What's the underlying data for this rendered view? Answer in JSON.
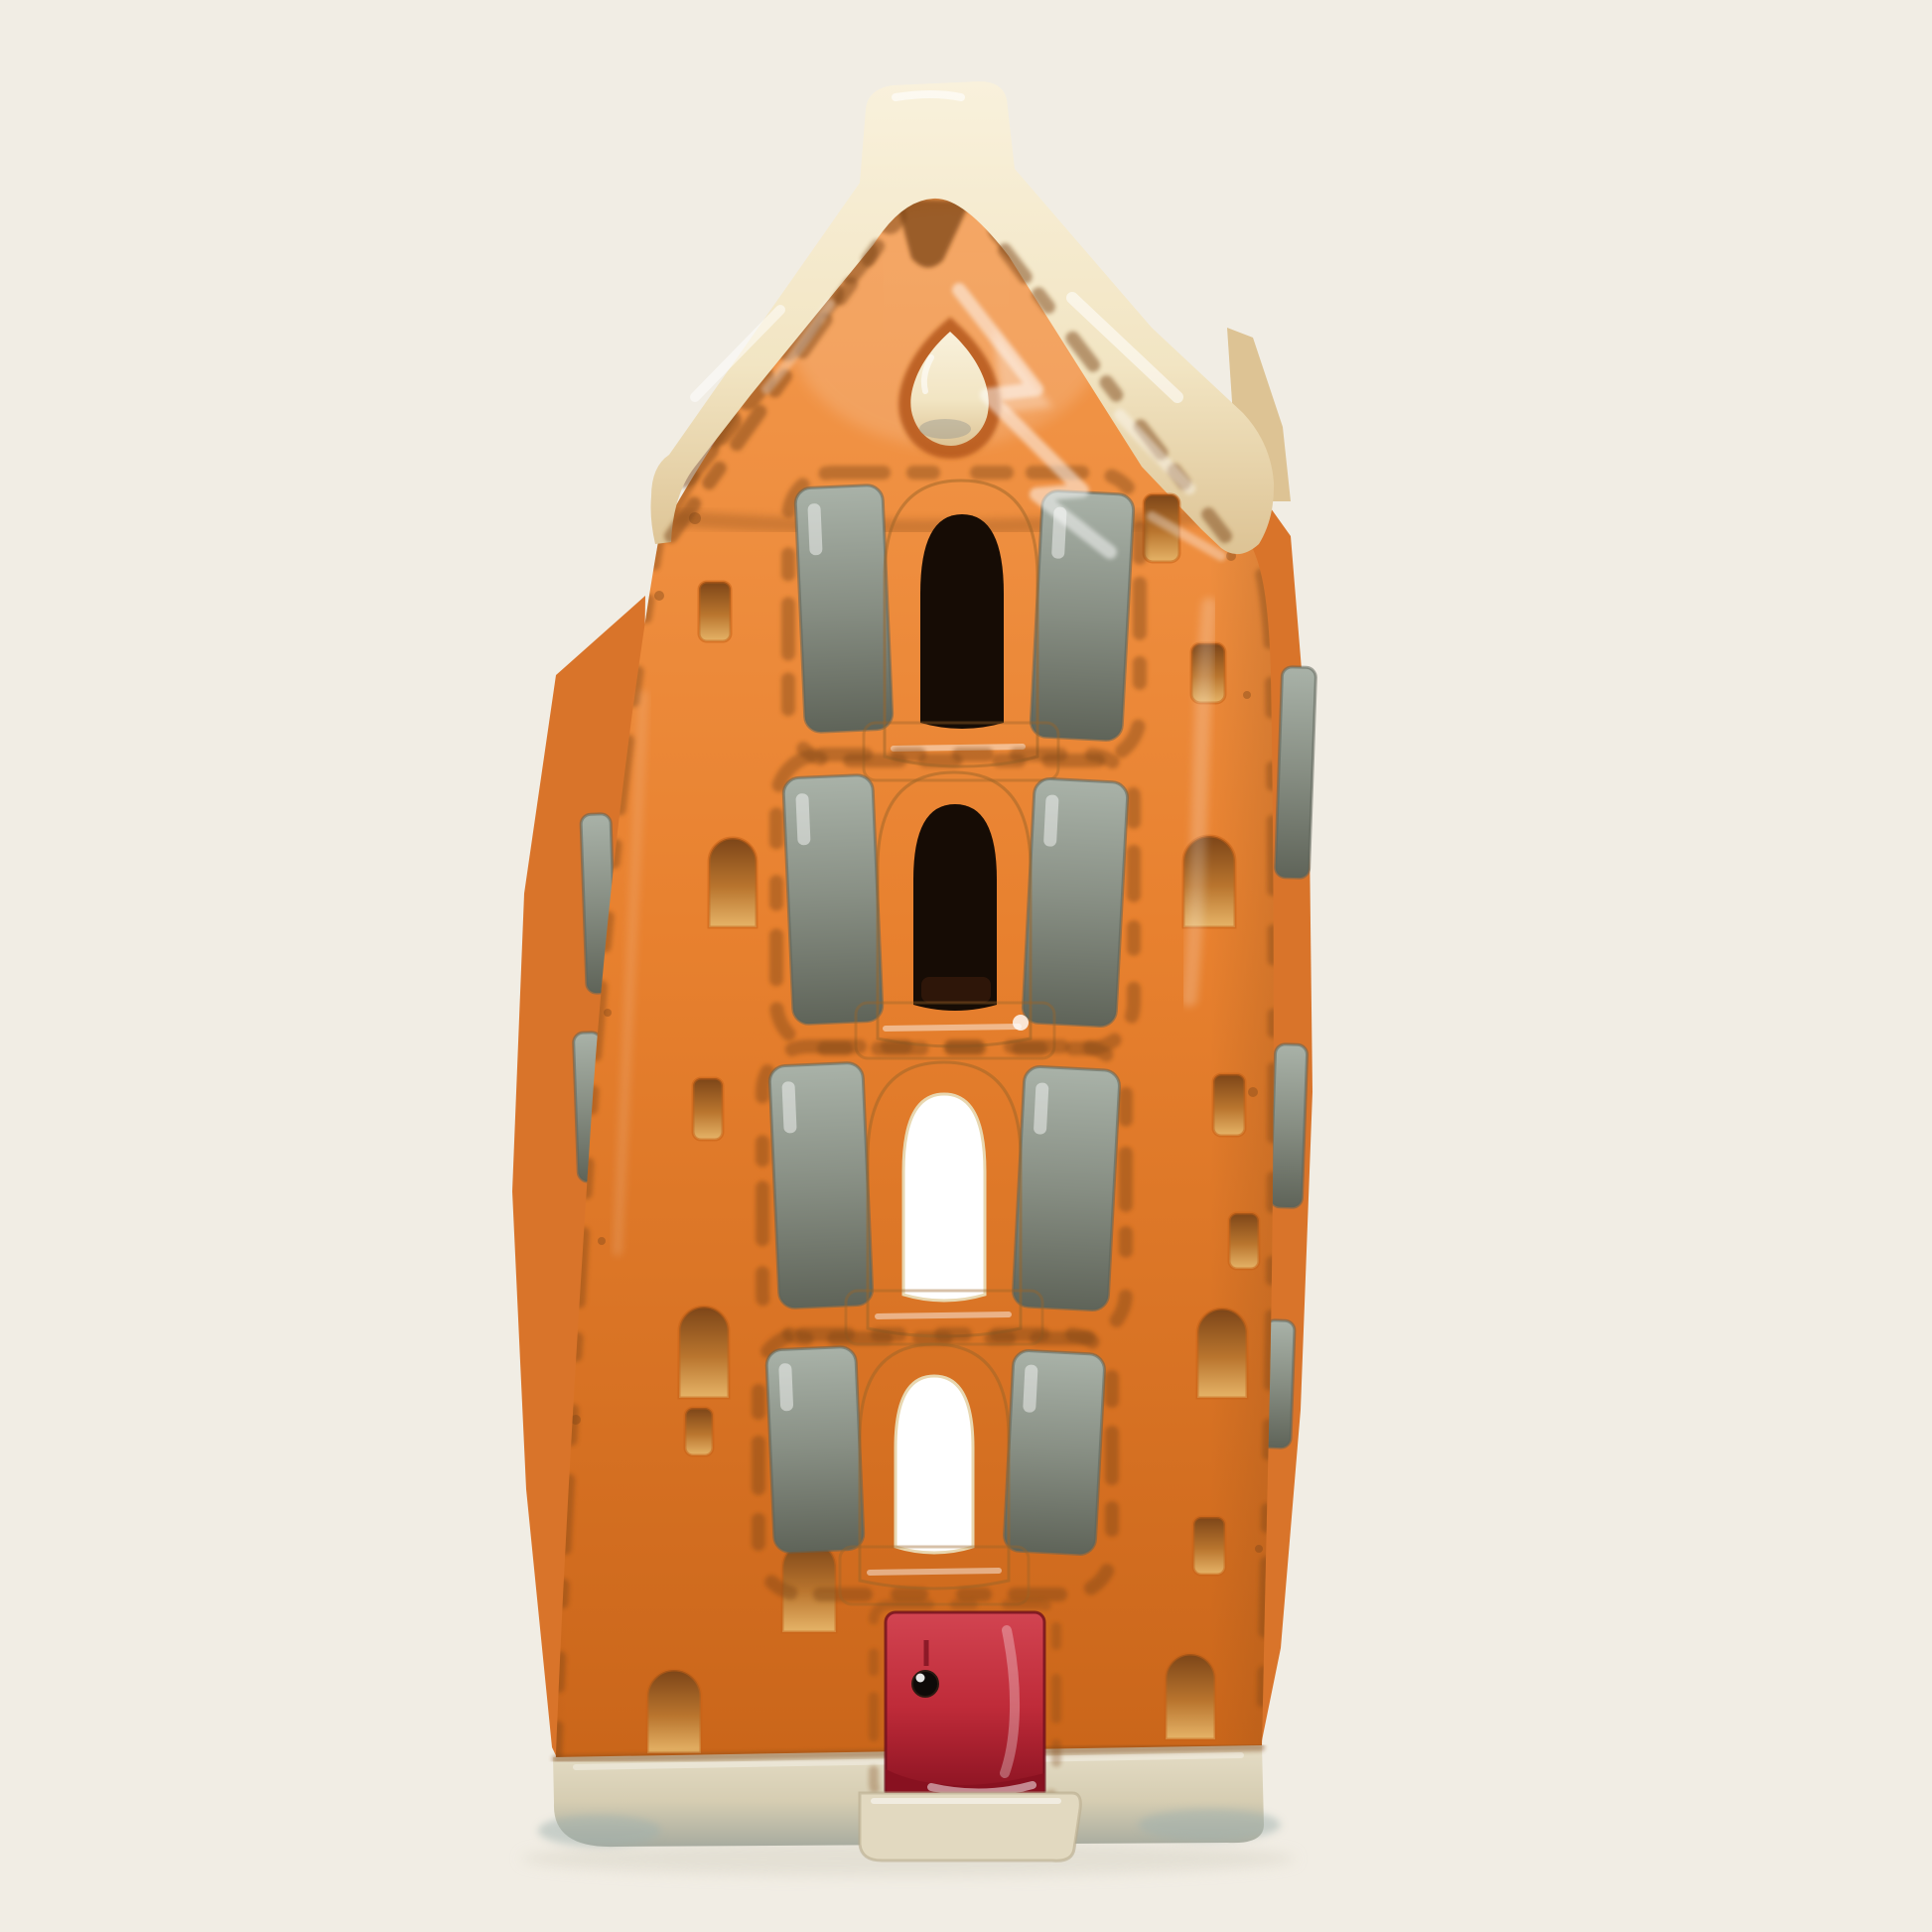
{
  "scene": {
    "kind": "product-photo",
    "subject": "ceramic canal-house tealight holder",
    "background_color": "#f1ede4"
  },
  "house": {
    "style": "Dutch canal house with bell gable",
    "front_windows": 4,
    "shutters_per_window": 2,
    "gable_windows": 1,
    "doors": 1,
    "body_color_name": "glazed orange",
    "shutter_color_name": "grey",
    "trim_color_name": "cream",
    "door_color_name": "red",
    "door_knob_color_name": "black"
  },
  "palette": {
    "bg": "#f1ede4",
    "orange": "#e8812f",
    "orange_light": "#f49a4e",
    "orange_deep": "#c76318",
    "side_orange": "#d9742a",
    "cream": "#f2e5c3",
    "cream_hi": "#f9f1dc",
    "cream_dark": "#ddc394",
    "gray": "#878e83",
    "gray_light": "#a9b2a8",
    "gray_dark": "#5f6459",
    "opening_dark": "#160c05",
    "opening_light": "#ffffff",
    "door_red": "#bf2b39",
    "door_red_hi": "#d24451",
    "door_red_dark": "#871120",
    "brown": "#7c4518",
    "base": "#d6cdb2",
    "base_hi": "#e5ddc6",
    "base_shadow": "#a7ab9f",
    "blue_tint": "#9fb0ad",
    "pink_fleck": "#e8b7c4",
    "impress_mid": "#b9752e",
    "impress_low": "#e6b468",
    "highlight": "#ffffff"
  }
}
